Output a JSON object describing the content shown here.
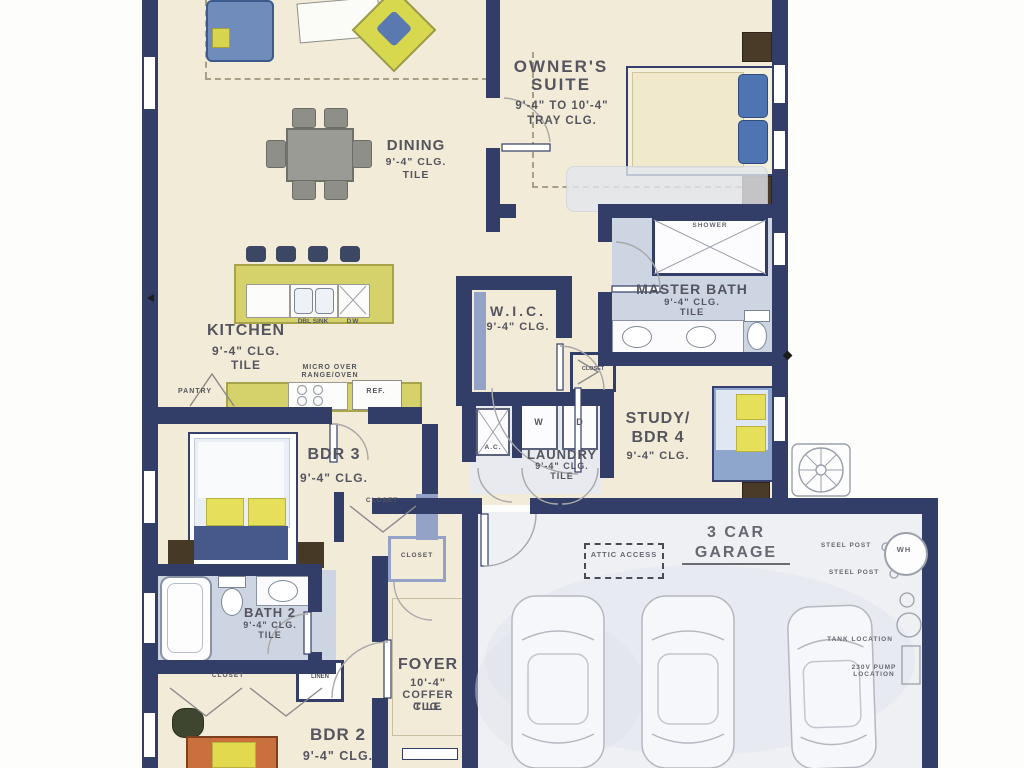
{
  "plan_title": "single family home floor plan",
  "rooms": {
    "owners_suite": {
      "name": "OWNER'S SUITE",
      "ceiling": "9'-4\" TO 10'-4\"",
      "ceiling_type": "TRAY CLG."
    },
    "dining": {
      "name": "DINING",
      "ceiling": "9'-4\" CLG.",
      "floor": "TILE"
    },
    "kitchen": {
      "name": "KITCHEN",
      "ceiling": "9'-4\" CLG.",
      "floor": "TILE"
    },
    "wic": {
      "name": "W.I.C.",
      "ceiling": "9'-4\" CLG."
    },
    "master_bath": {
      "name": "MASTER BATH",
      "ceiling": "9'-4\" CLG.",
      "floor": "TILE"
    },
    "study": {
      "name_line1": "STUDY/",
      "name_line2": "BDR 4",
      "ceiling": "9'-4\" CLG."
    },
    "laundry": {
      "name": "LAUNDRY",
      "ceiling": "9'-4\" CLG.",
      "floor": "TILE"
    },
    "bdr3": {
      "name": "BDR 3",
      "ceiling": "9'-4\" CLG."
    },
    "bath2": {
      "name": "BATH 2",
      "ceiling": "9'-4\" CLG.",
      "floor": "TILE"
    },
    "foyer": {
      "name": "FOYER",
      "ceiling": "10'-4\"",
      "ceiling_type": "COFFER CLG.",
      "floor": "TILE"
    },
    "bdr2": {
      "name": "BDR 2",
      "ceiling": "9'-4\" CLG."
    },
    "garage": {
      "name_line1": "3 CAR",
      "name_line2": "GARAGE"
    }
  },
  "fixtures": {
    "shower": "SHOWER",
    "dbl_sink": "DBL SINK",
    "dishwasher": "DW",
    "washer": "W",
    "dryer": "D",
    "ac": "A.C.",
    "fridge": "REF.",
    "pantry": "PANTRY",
    "linen": "LINEN",
    "closet": "CLOSET",
    "micro_line1": "MICRO OVER",
    "micro_line2": "RANGE/OVEN",
    "water_heater": "WH",
    "steel_post": "STEEL POST",
    "attic_access": "ATTIC ACCESS",
    "tank_location": "TANK LOCATION",
    "pump_location": "230V PUMP LOCATION"
  },
  "colors": {
    "wall": "#323e68",
    "wall_light": "#93a2c6",
    "floor_cream": "#f2ebd8",
    "bath_floor": "#cdd5e3",
    "garage_floor": "#eef0f4",
    "kitchen_island": "#d6d26b",
    "accent_yellow": "#d8d84f",
    "sofa_blue": "#6f8cba",
    "pillow_blue": "#4f74b2",
    "pillow_yellow": "#e5df5a"
  }
}
